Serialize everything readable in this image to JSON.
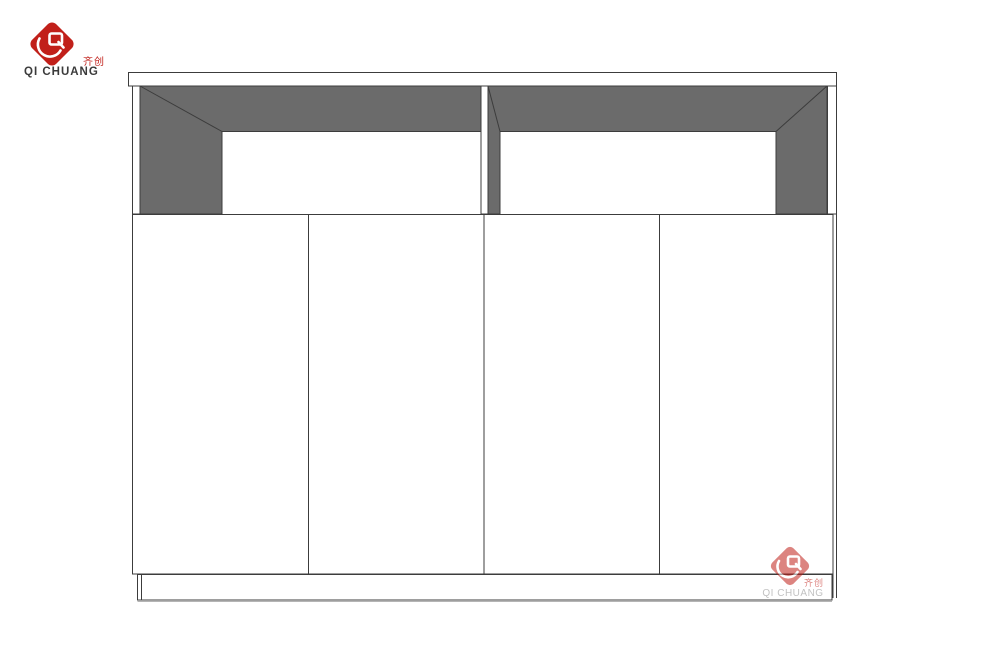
{
  "header_logo": {
    "company_zh": "齐创",
    "company_en": "QI CHUANG",
    "icon": "qichuang-diamond-logo-icon"
  },
  "watermark_logo": {
    "company_zh": "齐创",
    "company_en": "QI CHUANG",
    "icon": "qichuang-diamond-logo-icon"
  },
  "colors": {
    "accent_red": "#c1201a",
    "interior_gray": "#6b6b6b",
    "line_dark": "#3c3c3c",
    "text_dark": "#3b3b3b",
    "watermark_text_gray": "#8f8f8f",
    "background": "#ffffff"
  }
}
